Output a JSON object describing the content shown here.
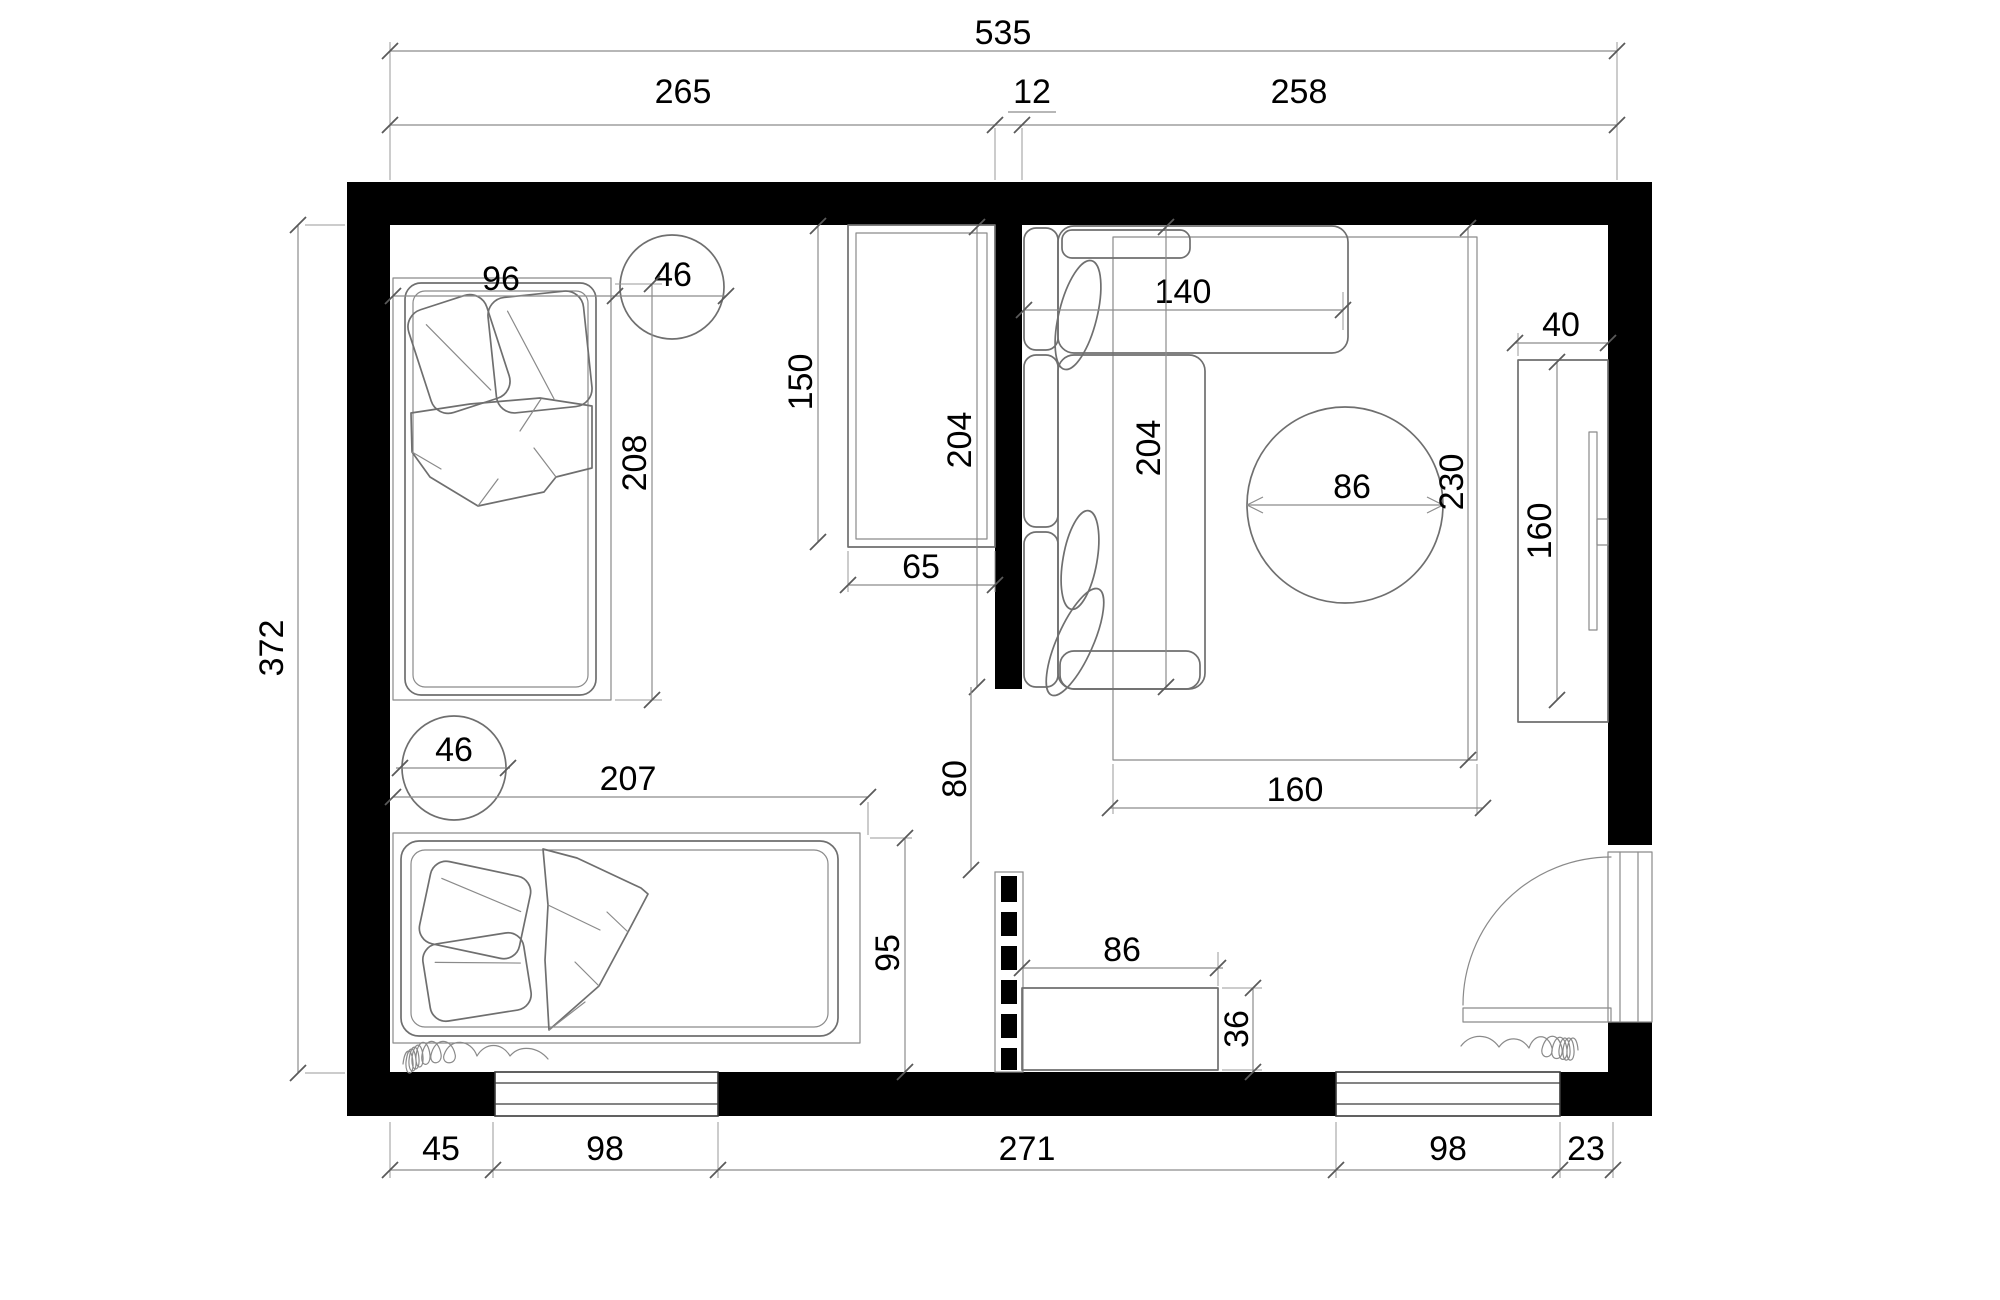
{
  "drawing": {
    "type": "architectural floor plan",
    "units": "cm",
    "colors": {
      "wall": "#000000",
      "furniture_line": "#6f6f6f",
      "dimension_line": "#8c8c8c",
      "text": "#000000",
      "background": "#ffffff"
    }
  },
  "dims": {
    "top": {
      "overall": "535",
      "left_room": "265",
      "partition": "12",
      "right_room": "258"
    },
    "side": {
      "height": "372"
    },
    "bottom": {
      "seg1": "45",
      "seg2": "98",
      "seg3": "271",
      "seg4": "98",
      "seg5": "23"
    },
    "bedroom": {
      "bed1_width": "96",
      "circle1": "46",
      "bed1_length": "208",
      "wardrobe_length": "150",
      "wardrobe_depth": "65",
      "partition_wall": "204",
      "door_opening": "80",
      "bed2_length": "207",
      "circle2": "46",
      "bed2_width": "95"
    },
    "living": {
      "sofa_chaise": "140",
      "sofa_length": "204",
      "table_diameter": "86",
      "rug_length": "230",
      "rug_width": "160",
      "tv_depth": "40",
      "tv_length": "160",
      "cabinet_width": "86",
      "cabinet_depth": "36"
    }
  },
  "objects": {
    "rooms": [
      "bedroom-left",
      "living-room-right"
    ],
    "furniture": [
      "single-bed-top",
      "single-bed-bottom",
      "bedside-circle-top",
      "bedside-circle-bottom",
      "wardrobe",
      "corner-sofa",
      "round-table",
      "rug",
      "tv-cabinet",
      "tv",
      "low-cabinet"
    ],
    "openings": [
      "window-bottom-left",
      "window-bottom-right",
      "entry-door-right-wall",
      "partition-door-opening",
      "dashed-partition-segment"
    ],
    "decor": [
      "curtain-squiggle-left",
      "curtain-squiggle-right"
    ]
  }
}
